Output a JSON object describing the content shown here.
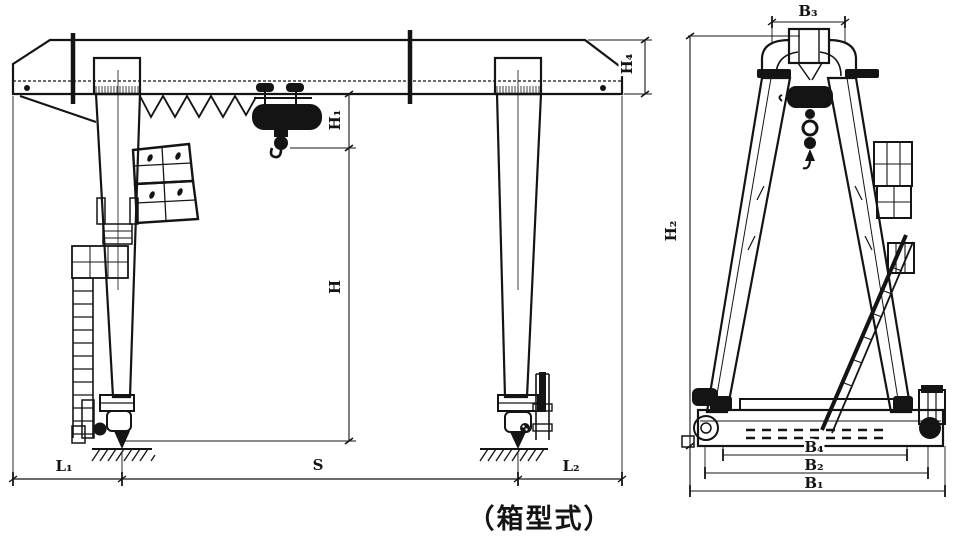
{
  "caption": "（箱型式）",
  "front_view": {
    "dim_labels": {
      "hook_to_girder_height": "H₁",
      "girder_end_height": "H₄",
      "lifting_height": "H",
      "left_cantilever": "L₁",
      "span": "S",
      "right_cantilever": "L₂"
    }
  },
  "side_view": {
    "dim_labels": {
      "top_width": "B₃",
      "overall_height": "H₂",
      "inner_base_width": "B₄",
      "wheel_base": "B₂",
      "overall_base_width": "B₁"
    }
  },
  "colors": {
    "ink": "#141414",
    "paper": "#ffffff"
  }
}
